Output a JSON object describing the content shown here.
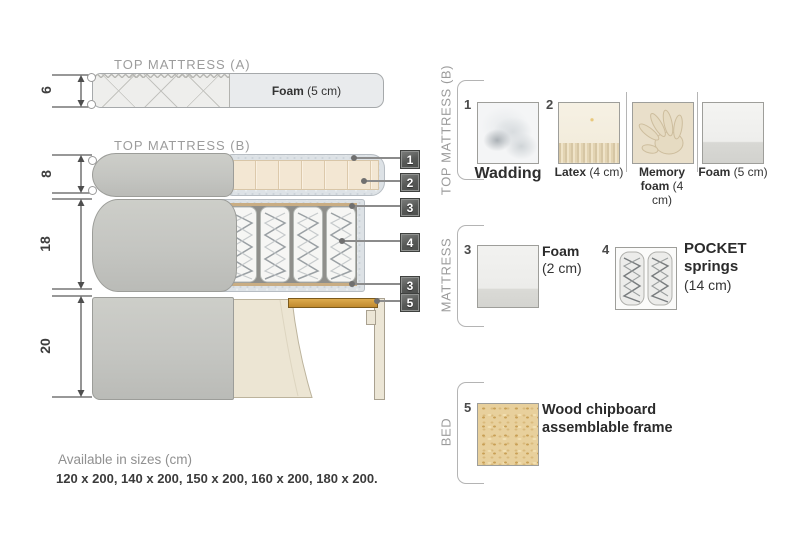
{
  "diagram": {
    "dims": [
      {
        "value": "6"
      },
      {
        "value": "8"
      },
      {
        "value": "18"
      },
      {
        "value": "20"
      }
    ],
    "top_mattress_a": {
      "title": "TOP MATTRESS (A)",
      "foam_name": "Foam",
      "foam_size": " (5 cm)"
    },
    "top_mattress_b": {
      "title": "TOP MATTRESS (B)"
    },
    "callouts": [
      {
        "num": "1"
      },
      {
        "num": "2"
      },
      {
        "num": "3"
      },
      {
        "num": "4"
      },
      {
        "num": "3"
      },
      {
        "num": "5"
      }
    ]
  },
  "legend": {
    "sections": [
      {
        "label": "TOP MATTRESS (B)"
      },
      {
        "label": "MATTRESS"
      },
      {
        "label": "BED"
      }
    ],
    "items": {
      "wadding": {
        "num": "1",
        "name": "Wadding"
      },
      "latex": {
        "num": "2",
        "name": "Latex",
        "size": " (4 cm)"
      },
      "memory_foam": {
        "name": "Memory foam",
        "size": " (4 cm)"
      },
      "foam5": {
        "name": "Foam",
        "size": " (5 cm)"
      },
      "foam2": {
        "num": "3",
        "name": "Foam",
        "size": "(2 cm)"
      },
      "pocket": {
        "num": "4",
        "name": "POCKET springs",
        "size": "(14 cm)"
      },
      "chipboard": {
        "num": "5",
        "name": "Wood chipboard assemblable frame"
      }
    }
  },
  "footer": {
    "line1": "Available in sizes (cm)",
    "line2": "120 x 200, 140 x 200, 150 x 200, 160 x 200, 180 x 200."
  },
  "colors": {
    "wood_slat": "#d29c44",
    "fabric_grey": "#c7c8c4",
    "latex_cream": "#f2e6d2",
    "callout_bg": "#565856"
  }
}
